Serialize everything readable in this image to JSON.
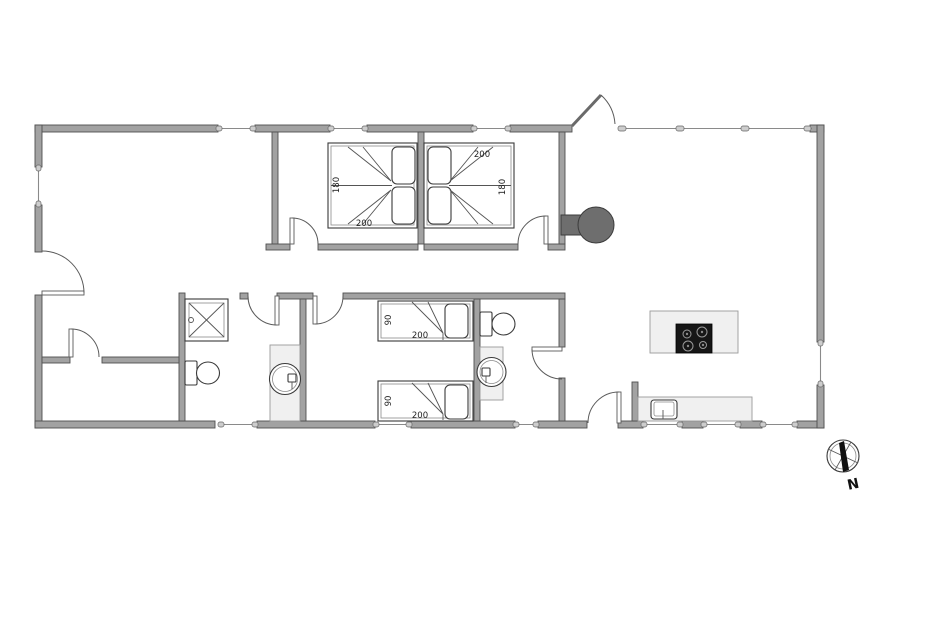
{
  "plan": {
    "type": "house-floor-plan",
    "labels": {
      "bedroom1": {
        "bed_width": "180",
        "bed_length": "200"
      },
      "bedroom2": {
        "bed_width": "180",
        "bed_length": "200"
      },
      "bedroom3": {
        "bed1_width": "90",
        "bed1_length": "200",
        "bed2_width": "90",
        "bed2_length": "200"
      },
      "compass_north": "N"
    },
    "colors": {
      "wall": "#a2a2a2",
      "wall_outline": "#4f4f4f",
      "fixture_outline": "#3a3a3a",
      "counter_fill": "#f0f0f0",
      "stove": "#6e6e6e",
      "cooktop": "#161616",
      "background": "#ffffff"
    }
  }
}
